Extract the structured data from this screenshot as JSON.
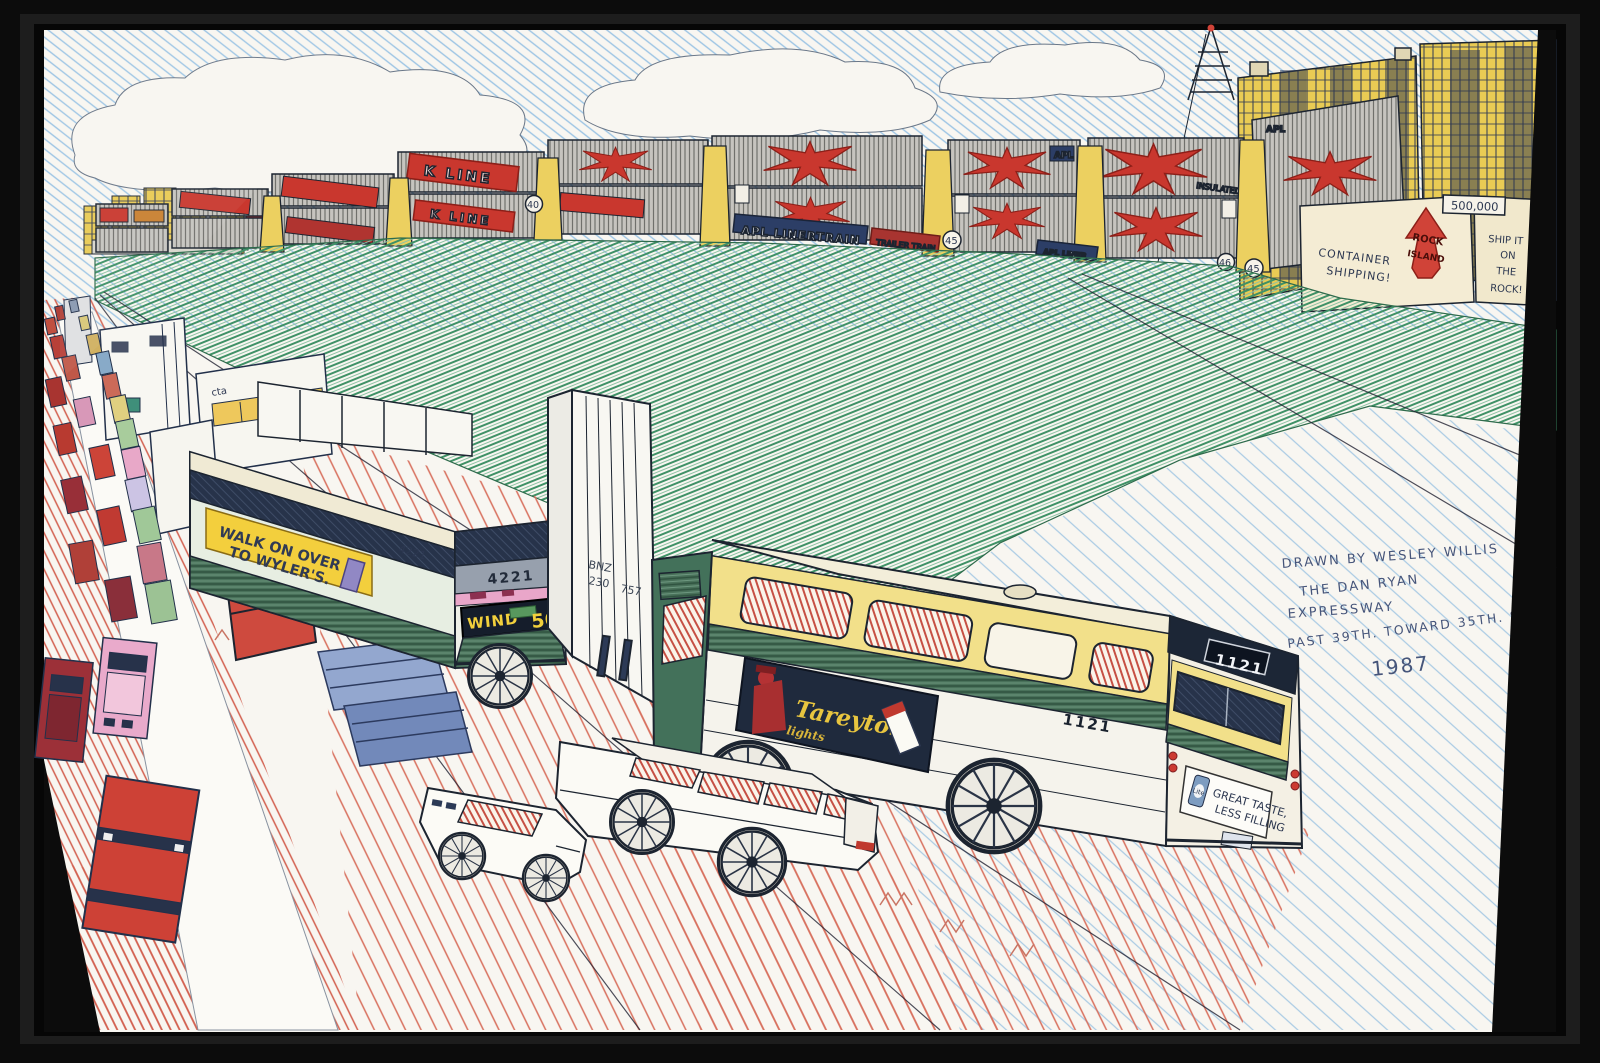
{
  "artwork": {
    "signature": {
      "line1": "DRAWN BY WESLEY WILLIS",
      "line2": "THE DAN RYAN",
      "line3": "EXPRESSWAY",
      "line4": "PAST 39TH. TOWARD 35TH. ST.",
      "line5": "1987"
    }
  },
  "train": {
    "apl_linertrain": "APL LINERTRAIN",
    "trailer_train": "TRAILER TRAIN",
    "apl_liner": "APL LINER",
    "apl": "APL",
    "k_line": "K LINE",
    "insulated": "INSULATED",
    "car_number_40": "40",
    "car_number_45": "45",
    "car_number_46": "46"
  },
  "yard": {
    "container_shipping_line1": "CONTAINER",
    "container_shipping_line2": "SHIPPING!",
    "rock_island_line1": "ROCK",
    "rock_island_line2": "ISLAND",
    "ship_it_line1": "SHIP IT",
    "ship_it_line2": "ON",
    "ship_it_line3": "THE",
    "ship_it_line4": "ROCK!",
    "tonnage": "500,000"
  },
  "bus_4221": {
    "fleet_number": "4221",
    "ad_line1": "WALK ON OVER",
    "ad_line2": "TO WYLER'S.",
    "destination": "WIND",
    "route_number": "56"
  },
  "bus_1121": {
    "fleet_number": "1121",
    "side_ad_brand": "Tareyton",
    "side_ad_sub": "lights",
    "rear_ad_line1": "GREAT TASTE,",
    "rear_ad_line2": "LESS FILLING",
    "rear_ad_can": "Lite"
  },
  "trailer_truck": {
    "reporting_mark": "BNZ",
    "number_line1": "230",
    "number_line2": "757"
  },
  "cta_bus_left": {
    "label": "cta"
  },
  "palette": {
    "ink": "#1c2430",
    "paper": "#f8f6f1",
    "frame_black": "#0c0c0c",
    "sky_blue": "#9cc4e4",
    "grass_green": "#3f9166",
    "container_gray": "#c9c7c2",
    "logo_red": "#c9372e",
    "structure_yellow": "#e9cb54",
    "cta_cream": "#f2e08a",
    "cta_green": "#49715a",
    "ad_yellow": "#f3cf3d",
    "destination_yellow": "#f2d03c",
    "stripe_pink": "#e9a6c9",
    "ground_red": "#d2604f"
  }
}
